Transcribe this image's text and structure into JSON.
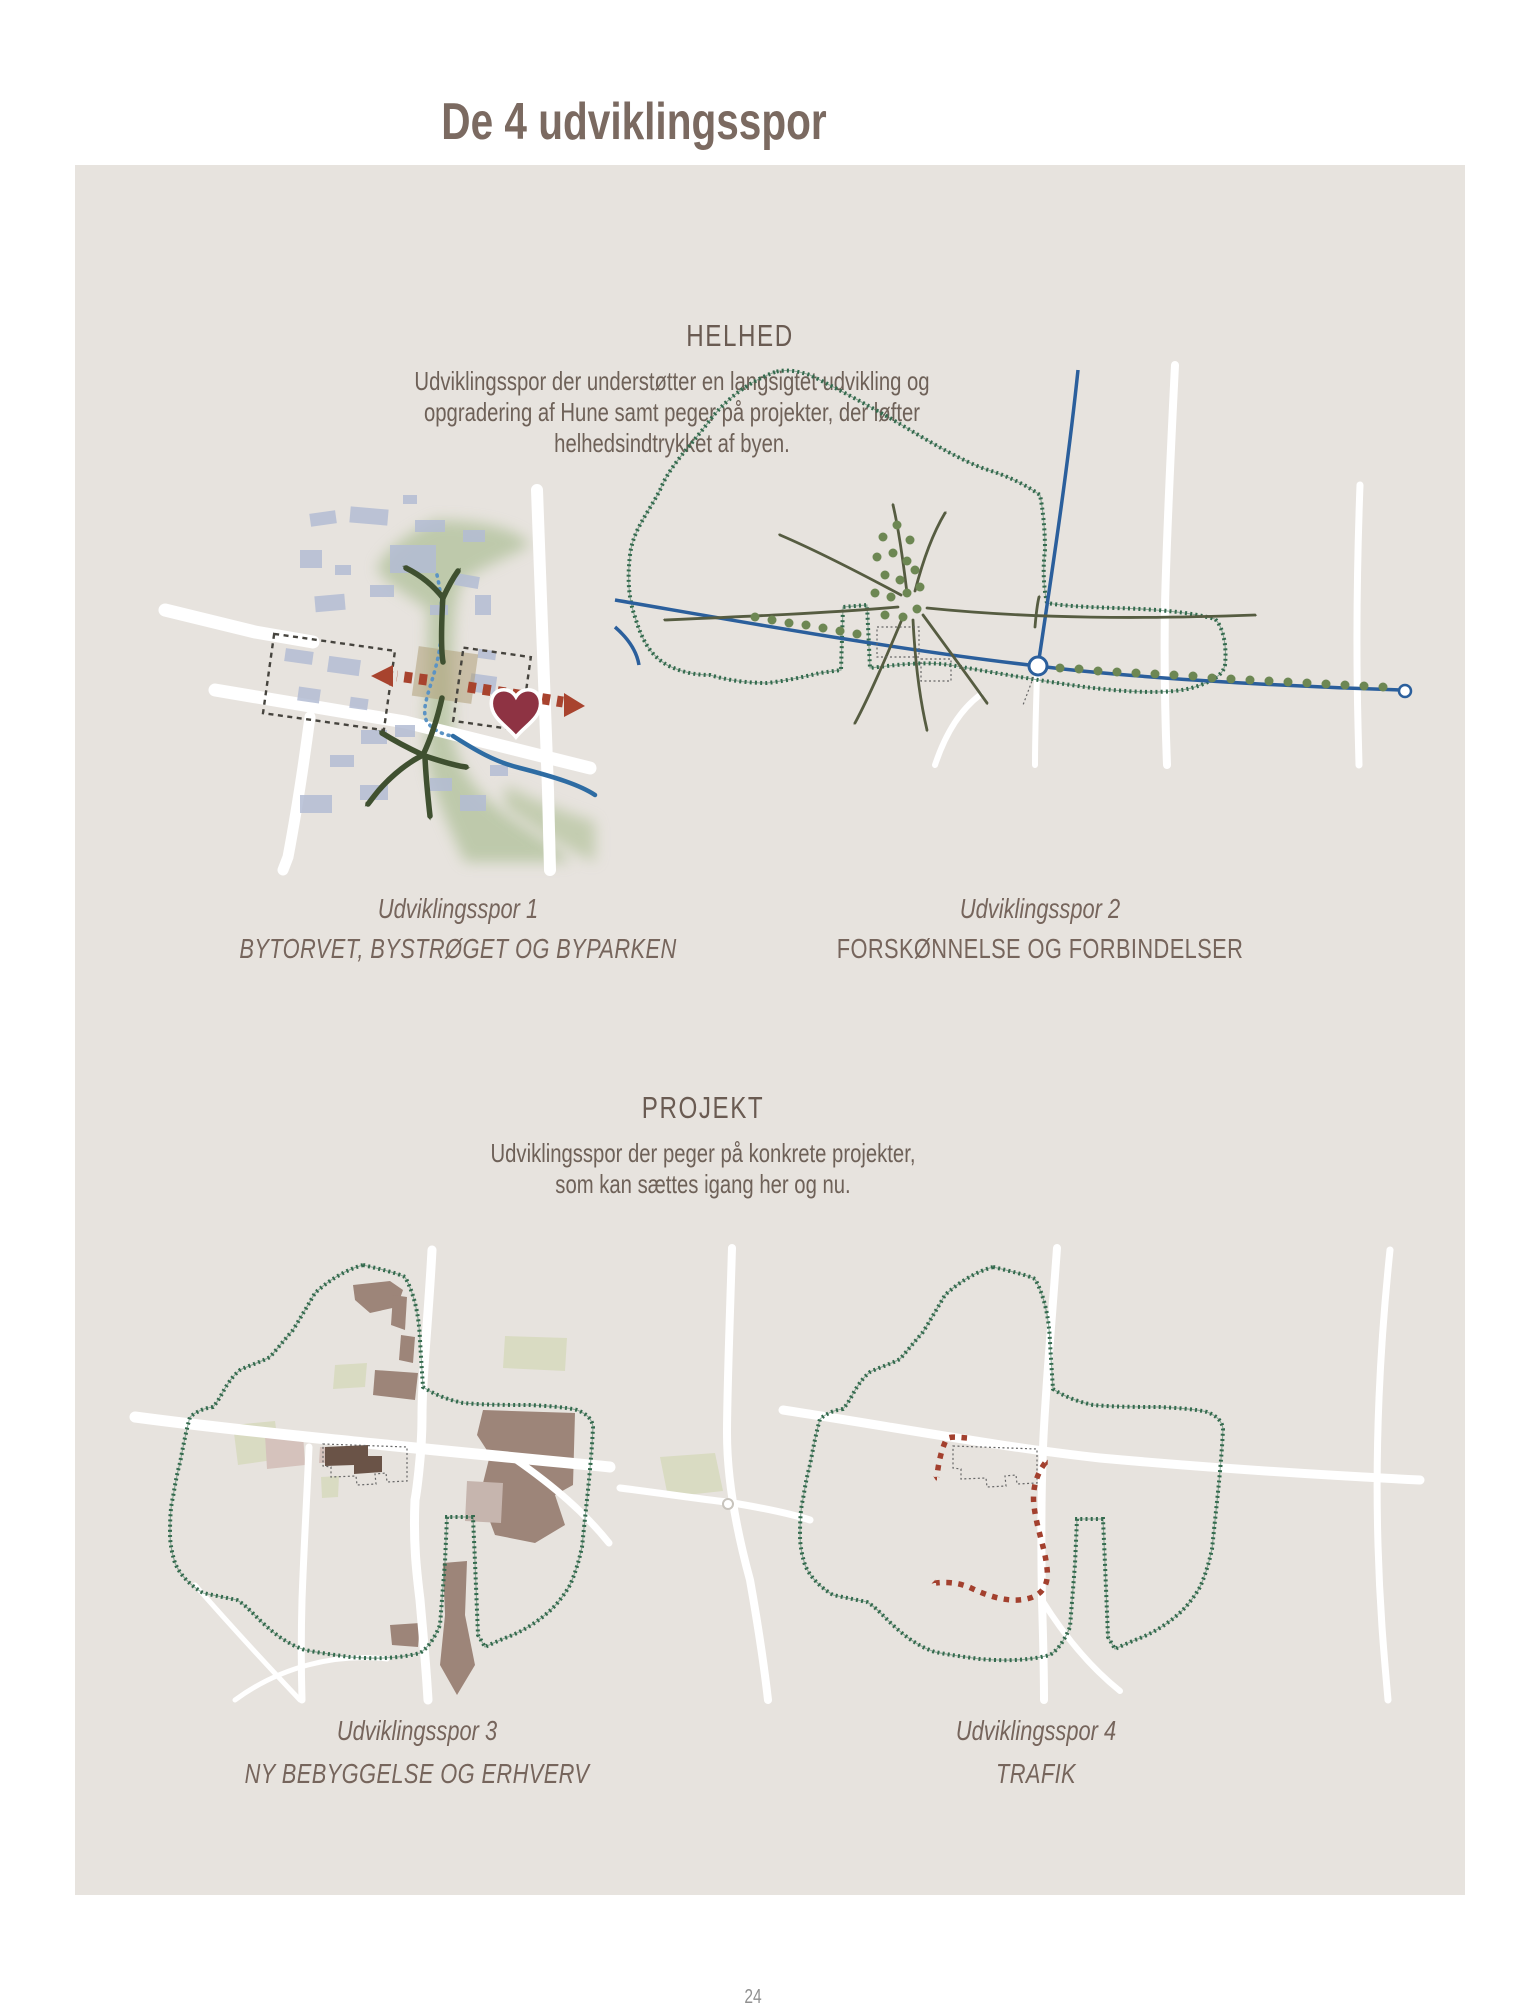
{
  "page": {
    "title": "De 4 udviklingsspor",
    "page_number": "24"
  },
  "colors": {
    "page_bg": "#ffffff",
    "panel_bg": "#e7e3de",
    "title_text": "#7b6a61",
    "heading_text": "#6a5b52",
    "body_text": "#6e6158",
    "caption_text": "#76655c",
    "boundary_green": "#336a4d",
    "olive_arrow": "#3f5030",
    "road_white": "#ffffff",
    "blue_road": "#2b5f9c",
    "river_blue": "#2e6ca3",
    "path_blue_dotted": "#5b93c4",
    "red_accent": "#a3402e",
    "heart_red": "#8e3343",
    "tree_green": "#6d8753",
    "building_footprint": "#b3bcd4",
    "development_brown": "#9d8579",
    "development_pink": "#d5c2bc",
    "field_pale_green": "#d9dbc2",
    "dark_building": "#6a5347",
    "corridor_tan": "#b0a07a"
  },
  "icons": {
    "heart": "heart-icon (town centre marker)",
    "roundabout": "circle node on blue road",
    "trees": "green tree dots",
    "stitched_boundary": "green hatched town boundary"
  },
  "sections": [
    {
      "heading": "HELHED",
      "paragraph_lines": [
        "Udviklingsspor der understøtter en langsigtet udvikling og",
        "opgradering af Hune samt peger på projekter, der løfter",
        "helhedsindtrykket af byen."
      ],
      "maps": [
        {
          "caption": "Udviklingsspor 1",
          "subtitle": "BYTORVET, BYSTRØGET OG BYPARKEN"
        },
        {
          "caption": "Udviklingsspor 2",
          "subtitle": "FORSKØNNELSE OG FORBINDELSER"
        }
      ]
    },
    {
      "heading": "PROJEKT",
      "paragraph_lines": [
        "Udviklingsspor der peger på konkrete projekter,",
        "som kan sættes igang her og nu."
      ],
      "maps": [
        {
          "caption": "Udviklingsspor 3",
          "subtitle": "NY BEBYGGELSE OG ERHVERV"
        },
        {
          "caption": "Udviklingsspor 4",
          "subtitle": "TRAFIK"
        }
      ]
    }
  ]
}
